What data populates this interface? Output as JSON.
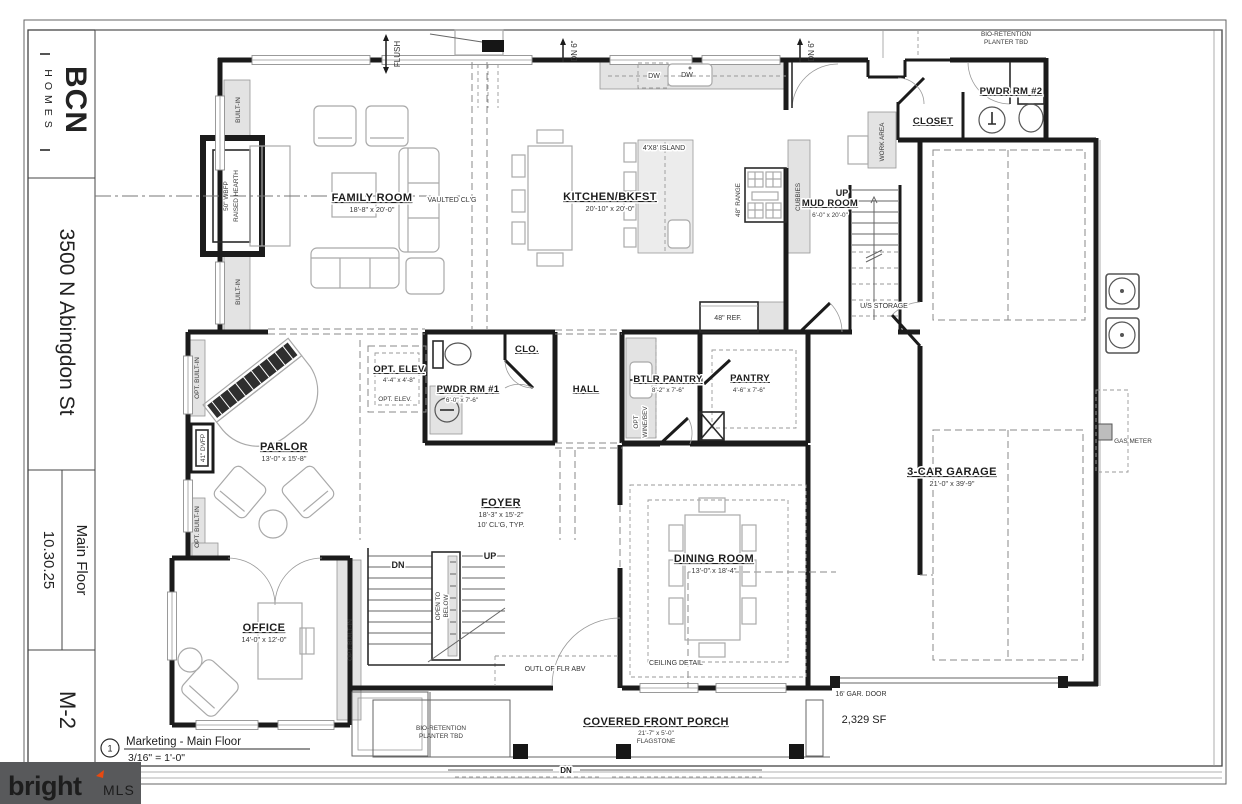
{
  "title_block": {
    "logo_main": "BCN",
    "logo_sub": "HOMES",
    "address": "3500 N Abingdon St",
    "date": "10.30.25",
    "floor": "Main Floor",
    "sheet": "M-2"
  },
  "footer": {
    "detail_number": "1",
    "title": "Marketing - Main Floor",
    "scale": "3/16\" = 1'-0\""
  },
  "watermark": {
    "brand": "bright",
    "suffix": "MLS",
    "accent_color": "#e8490f",
    "bg_color": "#58595b"
  },
  "labels": {
    "family_room_name": "FAMILY ROOM",
    "family_room_dims": "18'-8\" x 20'-0\"",
    "vaulted_clg": "VAULTED CL'G",
    "built_in_upper": "BUILT-IN",
    "built_in_lower": "BUILT-IN",
    "wbfp_line1": "50\" WBFP",
    "wbfp_line2": "RAISED HEARTH",
    "flush": "FLUSH",
    "dn6_left": "DN 6\"",
    "dn6_right": "DN 6\"",
    "kitchen_name": "KITCHEN/BKFST",
    "kitchen_dims": "20'-10\" x 20'-0\"",
    "island": "4'X8' ISLAND",
    "dw1": "DW",
    "dw2": "DW",
    "range": "48\" RANGE",
    "cubbies": "CUBBIES",
    "ref": "48\" REF.",
    "mud_room_name": "MUD ROOM",
    "mud_room_dims": "6'-0\" x 20'-0\"",
    "mud_up": "UP",
    "us_storage": "U/S STORAGE",
    "work_area": "WORK AREA",
    "closet_name": "CLOSET",
    "pwdr2_name": "PWDR RM #2",
    "bio_top_line1": "BIO-RETENTION",
    "bio_top_line2": "PLANTER TBD",
    "gas_meter": "GAS METER",
    "garage_name": "3-CAR GARAGE",
    "garage_dims": "21'-0\" x 39'-9\"",
    "gar_door": "16' GAR. DOOR",
    "total_sf": "2,329 SF",
    "parlor_name": "PARLOR",
    "parlor_dims": "13'-0\" x 15'-8\"",
    "opt_builtin_parlor_upper": "OPT. BUILT-IN",
    "opt_builtin_parlor_lower": "OPT. BUILT-IN",
    "dvfp": "41\" DVFP",
    "opt_elev_name": "OPT. ELEV",
    "opt_elev_dims": "4'-4\" x 4'-8\"",
    "opt_elev_small": "OPT. ELEV.",
    "pwdr1_name": "PWDR RM #1",
    "pwdr1_dims": "6'-0\" x 7'-6\"",
    "clo": "CLO.",
    "hall": "HALL",
    "btlr_name": "BTLR PANTRY",
    "btlr_dims": "8'-2\" x 7'-6\"",
    "wine_line1": "OPT",
    "wine_line2": "WINE/BEV",
    "pantry_name": "PANTRY",
    "pantry_dims": "4'-6\" x 7'-6\"",
    "foyer_name": "FOYER",
    "foyer_dims": "18'-3\" x 15'-2\"",
    "foyer_clg": "10' CL'G, TYP.",
    "foyer_up": "UP",
    "foyer_dn": "DN",
    "open_below_line1": "OPEN TO",
    "open_below_line2": "BELOW",
    "outl_flr_abv": "OUTL OF FLR ABV",
    "office_name": "OFFICE",
    "office_dims": "14'-0\" x 12'-0\"",
    "opt_builtin_office": "OPT. BUILT-IN",
    "dining_name": "DINING ROOM",
    "dining_dims": "13'-0\" x 18'-4\"",
    "ceiling_detail": "CEILING DETAIL",
    "porch_name": "COVERED FRONT PORCH",
    "porch_dims": "21'-7\" x 5'-0\"",
    "porch_material": "FLAGSTONE",
    "porch_dn": "DN",
    "bio_bottom_line1": "BIO-RETENTION",
    "bio_bottom_line2": "PLANTER TBD"
  }
}
